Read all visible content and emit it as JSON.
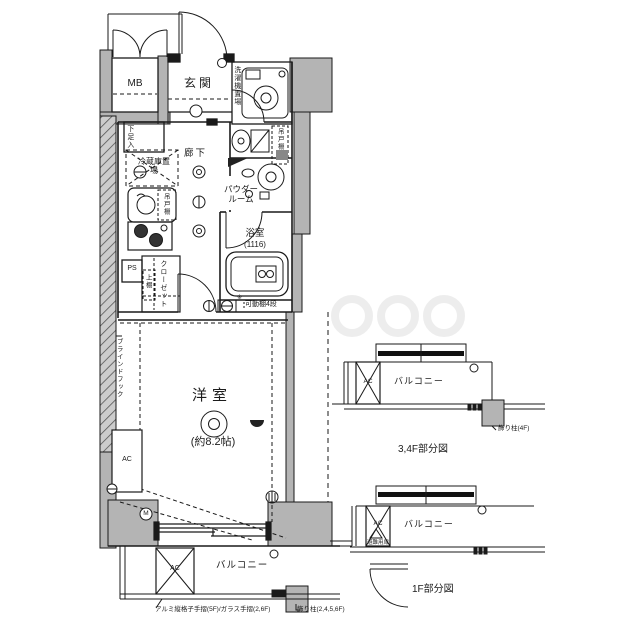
{
  "plan": {
    "mb": "MB",
    "entrance": "玄関",
    "laundry": "洗濯機置場",
    "shoe": "下足入",
    "hall": "廊下",
    "fridge": "冷蔵庫置場",
    "kitchen_shelf": "吊戸棚",
    "toilet_shelf": "吊戸棚",
    "powder": "パウダールーム",
    "bath": "浴室",
    "bath_size": "(1116)",
    "ps": "PS",
    "closet": "クローゼット",
    "closet_shelf": "上棚",
    "shelf_mark": "※",
    "shelf_note": "可動棚4段",
    "room": "洋室",
    "room_size": "(約8.2帖)",
    "blind_hook": "ブラインドフック",
    "ac": "AC",
    "meter_mark": "M",
    "balcony": "バルコニー",
    "ac_outdoor": "AC",
    "note_handrail": "アルミ縦格子手摺(5F)/ガラス手摺(2,6F)",
    "note_pillar": "飾り柱(2,4,5,6F)"
  },
  "fig34": {
    "caption": "3,4F部分図",
    "balcony": "バルコニー",
    "ac": "AC",
    "note_pillar": "飾り柱(4F)"
  },
  "fig1": {
    "caption": "1F部分図",
    "balcony": "バルコニー",
    "ac": "AC",
    "note_door": "避難用扉"
  },
  "colors": {
    "wall_fill": "#b4b4b4",
    "line": "#1a1a1a",
    "background": "#ffffff"
  }
}
